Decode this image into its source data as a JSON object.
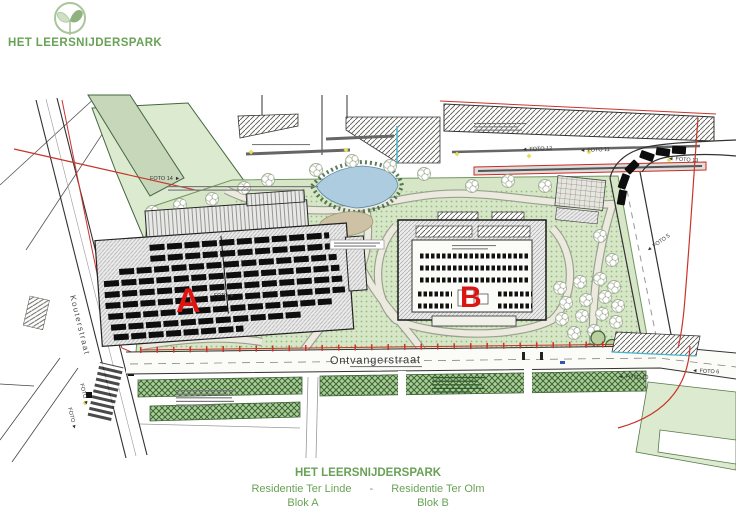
{
  "logo": {
    "title": "HET LEERSNIJDERSPARK"
  },
  "footer": {
    "title": "HET LEERSNIJDERSPARK",
    "residence_left": "Residentie Ter Linde",
    "separator": "-",
    "residence_right": "Residentie Ter Olm",
    "blok_left": "Blok A",
    "blok_right": "Blok B"
  },
  "plan": {
    "streets": {
      "bottom_street": "Ontvangerstraat",
      "left_street": "Kouterstraat"
    },
    "buildings": {
      "block_a_label": "A",
      "block_b_label": "B"
    },
    "foto_labels": [
      {
        "label": "FOTO 14"
      },
      {
        "label": "FOTO 12"
      },
      {
        "label": "FOTO 11"
      },
      {
        "label": "FOTO 13"
      },
      {
        "label": "FOTO 5"
      },
      {
        "label": "FOTO 10"
      },
      {
        "label": "FOTO 6"
      },
      {
        "label": "FOTO"
      },
      {
        "label": "FOTO"
      },
      {
        "label": "FOTO"
      }
    ],
    "icons": {
      "arrow_left": "◄",
      "arrow_right": "►"
    },
    "colors": {
      "logo_green": "#a9c59b",
      "text_green": "#69a257",
      "park_green": "#d6e6c6",
      "groundcover_green": "#c2dbae",
      "hatch_strip_green": "#a8cf96",
      "pond_blue": "#adccdf",
      "boundary_red": "#c9342a",
      "building_label_red": "#dd1512"
    }
  }
}
